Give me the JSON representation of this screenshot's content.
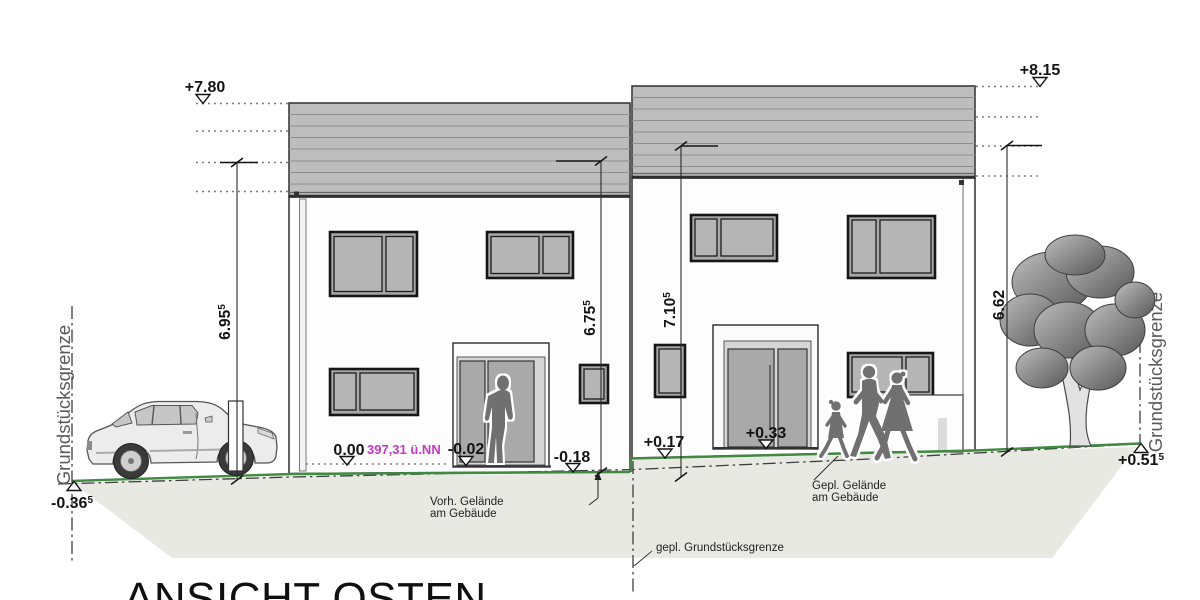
{
  "drawing": {
    "title": "ANSICHT OSTEN",
    "levels": {
      "left_roof": "+7.80",
      "right_roof": "+8.15",
      "zero": "0.00",
      "zero_datum": "397,31 ü.NN",
      "left_door": "-0.02",
      "left_base": "-0.18",
      "right_base": "+0.17",
      "right_door": "+0.33",
      "left_boundary": {
        "value": "-0.36",
        "sup": "5"
      },
      "right_boundary": {
        "value": "+0.51",
        "sup": "5"
      }
    },
    "dimensions": {
      "left_building_height": {
        "value": "6.95",
        "sup": "5"
      },
      "left_building_inner_height": {
        "value": "6.75",
        "sup": "5"
      },
      "right_building_inner_height": {
        "value": "7.10",
        "sup": "5"
      },
      "right_building_height": {
        "value": "6.62",
        "sup": ""
      }
    },
    "labels": {
      "left_property_line": "Grundstücksgrenze",
      "right_property_line": "Grundstücksgrenze",
      "existing_grade_line1": "Vorh. Gelände",
      "existing_grade_line2": "am Gebäude",
      "planned_grade_line1": "Gepl. Gelände",
      "planned_grade_line2": "am Gebäude",
      "planned_property_line": "gepl. Grundstücksgrenze"
    },
    "colors": {
      "grade_line_green": "#3f8b3f",
      "datum_magenta": "#c438c4",
      "terrain_fill": "#e9e9e3",
      "roof_band_fill": "#bdbdbd"
    }
  }
}
